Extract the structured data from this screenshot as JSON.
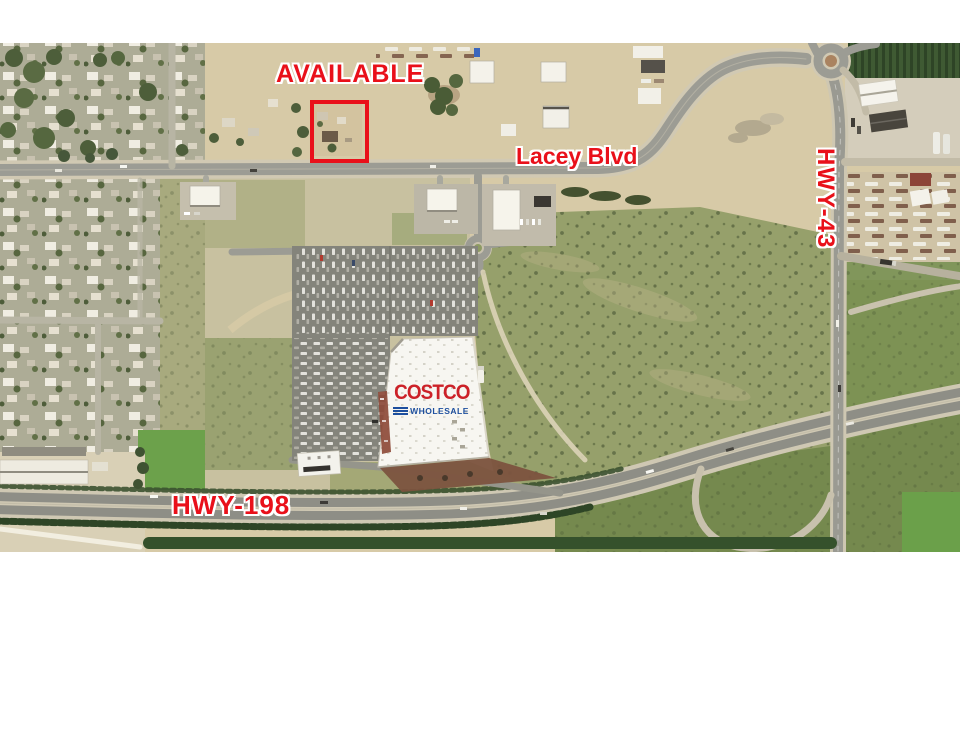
{
  "aerial": {
    "description": "Aerial site map: available parcel on Lacey Blvd near Costco, HWY-198 and HWY-43",
    "labels": {
      "available": "AVAILABLE",
      "lacey": "Lacey Blvd",
      "hwy43": "HWY-43",
      "hwy198": "HWY-198"
    },
    "colors": {
      "label_red": "#e9101a",
      "box_red": "#e9101a",
      "costco_red": "#cc2128",
      "costco_blue": "#1d4f9e",
      "dirt_tan": "#d7caa7",
      "field_olive": "#96a06b",
      "freeway_gray": "#8e8e86",
      "page_white": "#ffffff"
    },
    "costco": {
      "name": "COSTCO",
      "subtitle": "WHOLESALE"
    }
  }
}
